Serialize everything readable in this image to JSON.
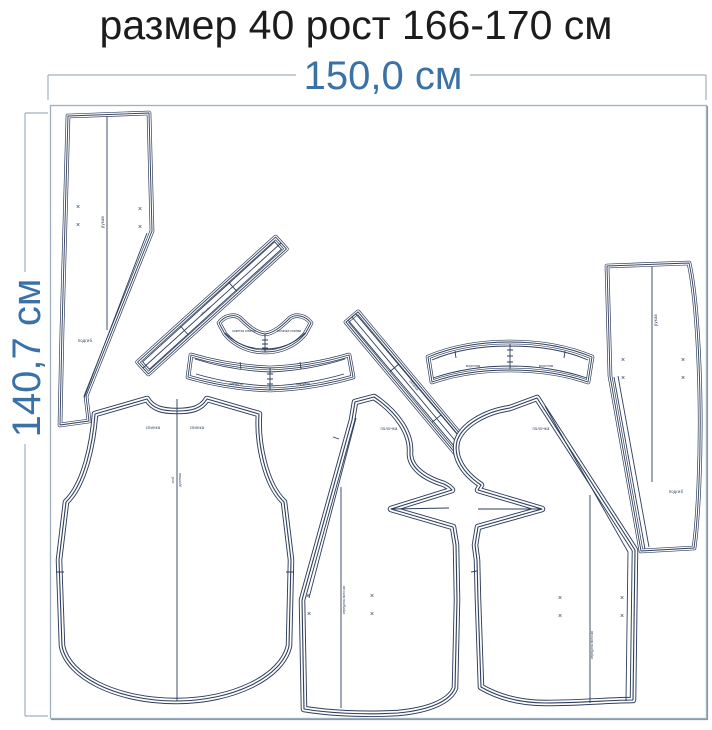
{
  "title": "размер 40 рост 166-170 см",
  "dimensions": {
    "width": "150,0 см",
    "height": "140,7 см"
  },
  "marks": {
    "x": "×"
  },
  "pieces": {
    "left_sleeve": {
      "grain": "рукав",
      "hem": "подгиб"
    },
    "right_sleeve": {
      "grain": "рукав",
      "hem": "подгиб"
    },
    "back": {
      "label_left": "спинка",
      "label_right": "спинка",
      "fold": "сгиб",
      "grain": "долевая"
    },
    "front_left": {
      "label": "полочка",
      "grain": "середина полочки"
    },
    "front_right": {
      "label": "полочка",
      "grain": "середина полочки"
    },
    "yoke": {
      "label_left": "кокетка спинки",
      "label_right": "обтачка спинки"
    },
    "neck_band": {
      "label_left": "манжета",
      "label_right": "манжета"
    },
    "collar_band": {
      "label_left": "воротник",
      "label_right": "воротник"
    },
    "bias_strip_1": {
      "label": "обтачка"
    },
    "bias_strip_2": {
      "label": "обтачка"
    }
  },
  "colors": {
    "accent": "#3a72a8",
    "outline": "#2e3e5c",
    "frame": "#9fb0c0",
    "title_text": "#1c1c1c"
  }
}
